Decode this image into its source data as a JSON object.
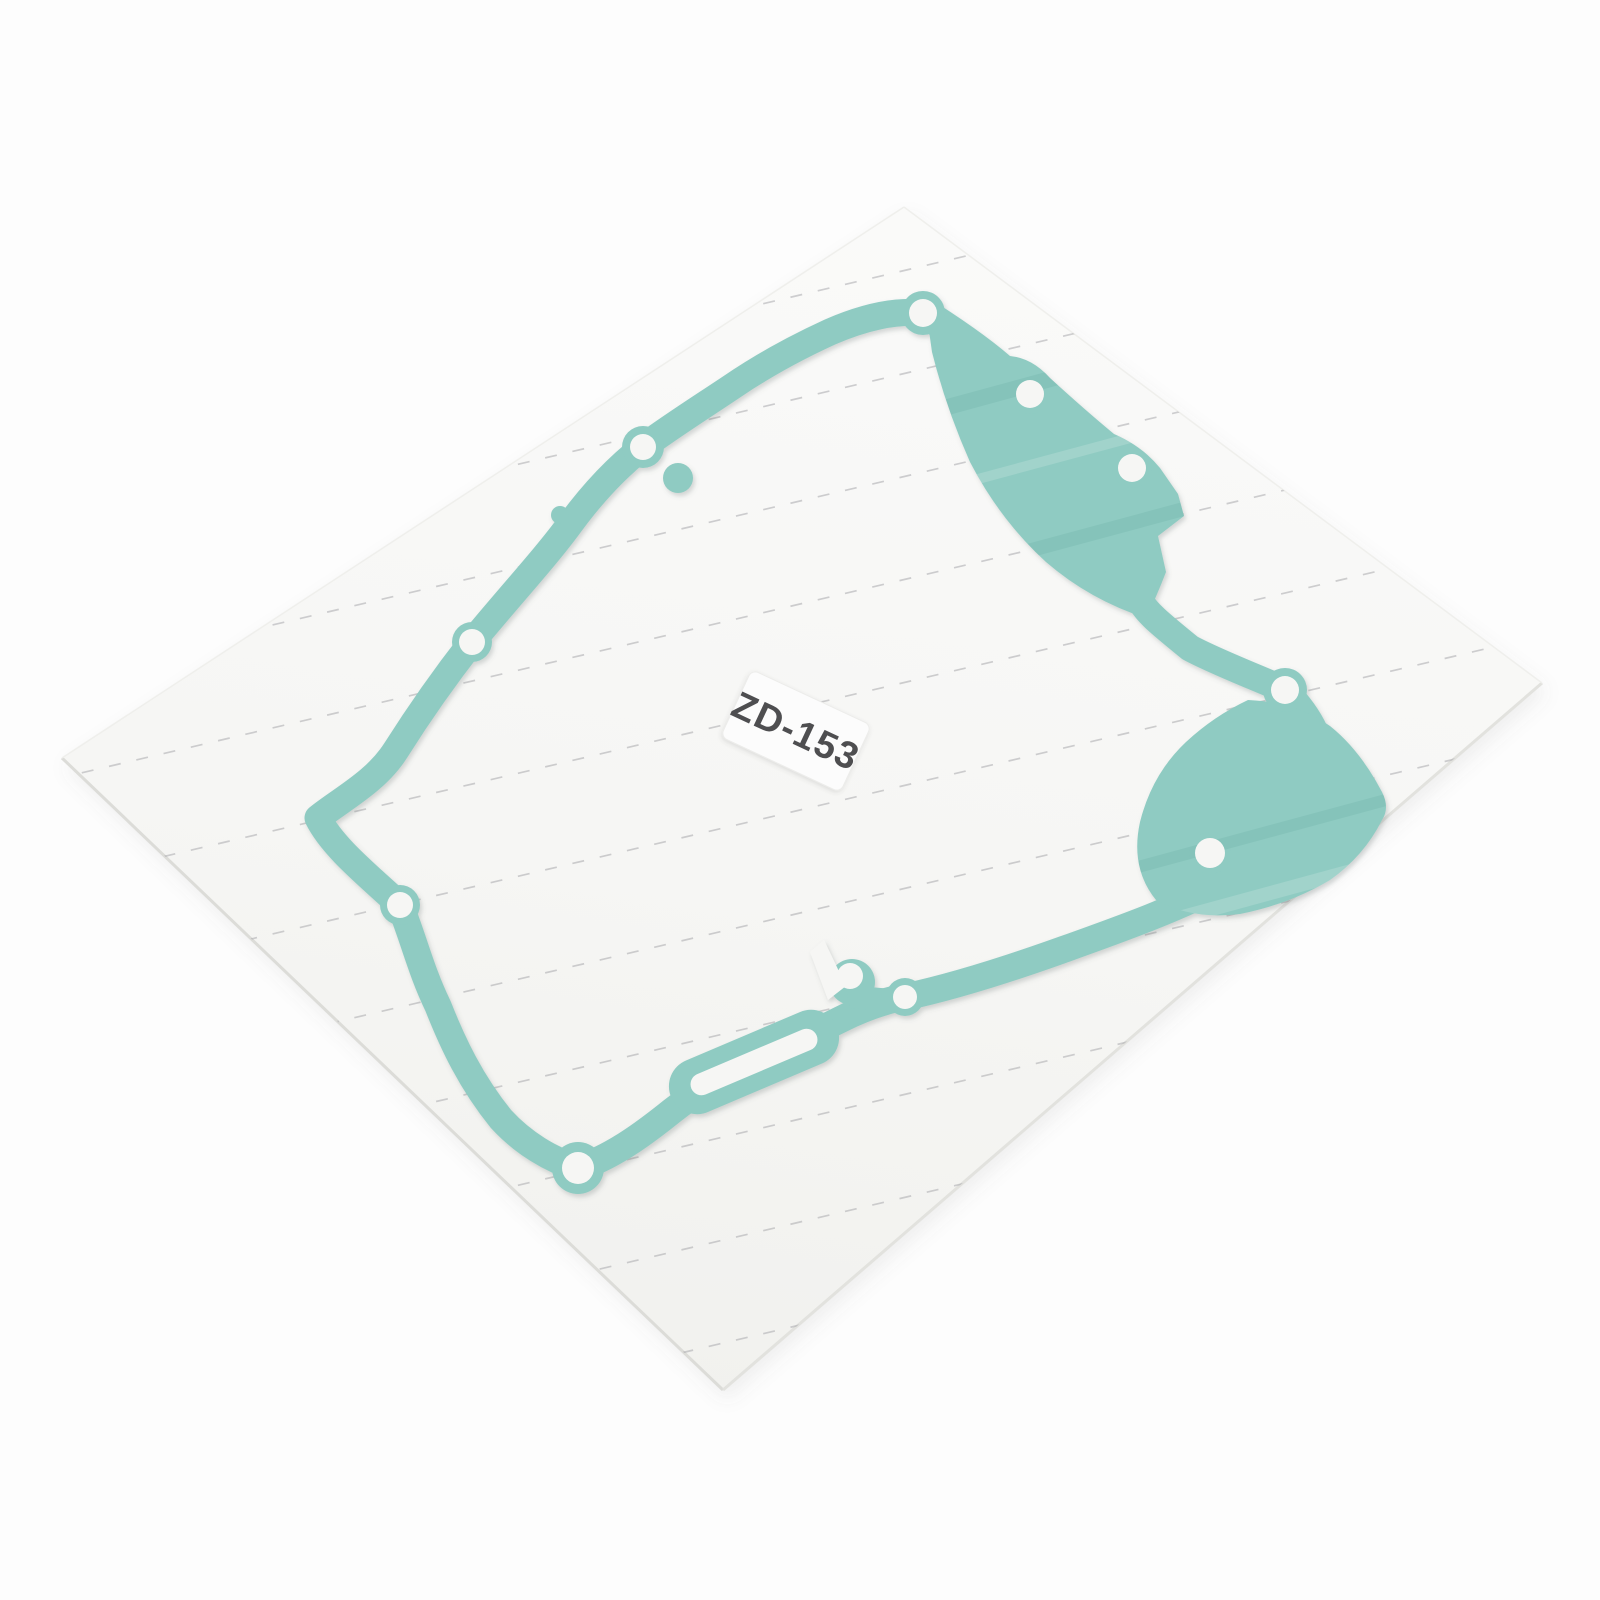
{
  "product": {
    "description": "Teal engine clutch cover gasket lying on a white release-paper sheet with dashed perforation lines",
    "label_text": "ZD-153"
  },
  "colors": {
    "background": "#fdfdfd",
    "paper": "#f6f6f4",
    "gasket_teal": "#8fcbc2",
    "label_sticker": "#fcfcfc",
    "label_text_gray": "#4e4e50",
    "perforation_line_gray": "#a9a9ad"
  }
}
